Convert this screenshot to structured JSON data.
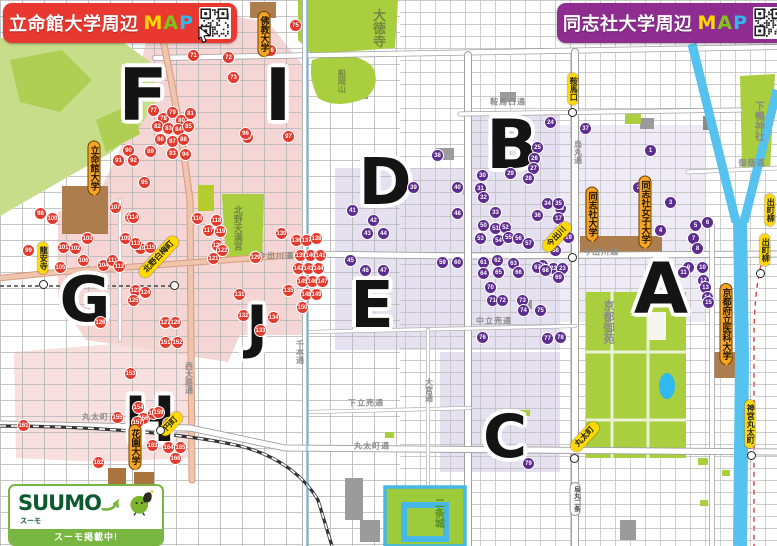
{
  "banners": {
    "left": {
      "title": "立命館大学周辺",
      "map_m": "M",
      "map_a": "A",
      "map_p": "P",
      "bg": "#e8382f"
    },
    "right": {
      "title": "同志社大学周辺",
      "map_m": "M",
      "map_a": "A",
      "map_p": "P",
      "bg": "#8e2d8f"
    }
  },
  "map_colors": {
    "red_marker": "#e33a2e",
    "purple_marker": "#5d2c8f",
    "pink_zone": "#f5cfcc",
    "purple_zone": "#ded9ec",
    "park": "#a9ce3e",
    "river": "#55c2ef",
    "map_m": "#ffd800",
    "map_a": "#7fc31c",
    "map_p": "#2fb9ee"
  },
  "suumo": {
    "brand": "SUUMO",
    "brand_sub": "スーモ",
    "banner": "スーモ掲載中!"
  },
  "zones": [
    {
      "label": "F",
      "x": 143,
      "y": 95,
      "size": 72
    },
    {
      "label": "I",
      "x": 278,
      "y": 95,
      "size": 72
    },
    {
      "label": "G",
      "x": 85,
      "y": 300,
      "size": 62
    },
    {
      "label": "J",
      "x": 257,
      "y": 327,
      "size": 58
    },
    {
      "label": "H",
      "x": 150,
      "y": 420,
      "size": 62
    },
    {
      "label": "D",
      "x": 385,
      "y": 183,
      "size": 64
    },
    {
      "label": "E",
      "x": 372,
      "y": 306,
      "size": 64
    },
    {
      "label": "B",
      "x": 512,
      "y": 146,
      "size": 68
    },
    {
      "label": "C",
      "x": 505,
      "y": 437,
      "size": 60
    },
    {
      "label": "A",
      "x": 661,
      "y": 289,
      "size": 70
    }
  ],
  "universities": [
    {
      "label": "立命館大学",
      "x": 94,
      "y": 168
    },
    {
      "label": "佛教大学",
      "x": 264,
      "y": 34
    },
    {
      "label": "花園大学",
      "x": 135,
      "y": 447
    },
    {
      "label": "同志社大学",
      "x": 592,
      "y": 214
    },
    {
      "label": "同志社女子大学",
      "x": 645,
      "y": 212
    },
    {
      "label": "京都府立医科大学",
      "x": 726,
      "y": 324
    }
  ],
  "stations": [
    {
      "label": "龍安寺",
      "x": 43,
      "y": 258,
      "kind": "v",
      "dot": [
        43,
        284
      ]
    },
    {
      "label": "北野白梅町",
      "x": 159,
      "y": 257,
      "kind": "d",
      "dot": [
        174,
        285
      ]
    },
    {
      "label": "円町",
      "x": 171,
      "y": 424,
      "kind": "d",
      "dot": [
        160,
        430
      ]
    },
    {
      "label": "鞍馬口",
      "x": 573,
      "y": 89,
      "kind": "v",
      "dot": [
        572,
        112
      ]
    },
    {
      "label": "今出川",
      "x": 557,
      "y": 237,
      "kind": "d",
      "dot": [
        572,
        257
      ]
    },
    {
      "label": "丸太町",
      "x": 585,
      "y": 437,
      "kind": "d",
      "dot": [
        574,
        458
      ]
    },
    {
      "label": "烏丸二条",
      "x": 575,
      "y": 499,
      "kind": "w",
      "dot": null
    },
    {
      "label": "神宮丸太町",
      "x": 750,
      "y": 424,
      "kind": "v",
      "dot": [
        751,
        455
      ]
    },
    {
      "label": "出町柳",
      "x": 770,
      "y": 210,
      "kind": "v",
      "dot": null
    },
    {
      "label": "出町柳",
      "x": 765,
      "y": 250,
      "kind": "v",
      "dot": [
        760,
        273
      ]
    }
  ],
  "places": [
    {
      "label": "大徳寺",
      "x": 378,
      "y": 28,
      "color": "#74883e",
      "vertical": true,
      "size": 13
    },
    {
      "label": "船岡山",
      "x": 341,
      "y": 81,
      "color": "#74883e",
      "vertical": true,
      "size": 8
    },
    {
      "label": "北野天満宮",
      "x": 237,
      "y": 228,
      "color": "#74883e",
      "vertical": true,
      "size": 9
    },
    {
      "label": "下鴨神社",
      "x": 757,
      "y": 121,
      "color": "#8a8a8a",
      "vertical": true,
      "size": 10
    },
    {
      "label": "京都御苑",
      "x": 607,
      "y": 322,
      "color": "#8a8a8a",
      "vertical": true,
      "size": 11
    },
    {
      "label": "二条城",
      "x": 437,
      "y": 513,
      "color": "#4f8f22",
      "vertical": true,
      "size": 10
    }
  ],
  "roads": [
    {
      "label": "今出川通",
      "x": 276,
      "y": 256,
      "vertical": false
    },
    {
      "label": "今出川通",
      "x": 601,
      "y": 252,
      "vertical": false
    },
    {
      "label": "鞍馬口通",
      "x": 508,
      "y": 102,
      "vertical": false
    },
    {
      "label": "烏丸通",
      "x": 578,
      "y": 152,
      "vertical": true
    },
    {
      "label": "千本通",
      "x": 300,
      "y": 352,
      "vertical": true
    },
    {
      "label": "大宮通",
      "x": 429,
      "y": 390,
      "vertical": true
    },
    {
      "label": "西大路通",
      "x": 189,
      "y": 378,
      "vertical": true
    },
    {
      "label": "丸太町通",
      "x": 100,
      "y": 417,
      "vertical": false
    },
    {
      "label": "丸太町通",
      "x": 372,
      "y": 446,
      "vertical": false
    },
    {
      "label": "下立売通",
      "x": 366,
      "y": 403,
      "vertical": false
    },
    {
      "label": "中立売通",
      "x": 494,
      "y": 321,
      "vertical": false
    },
    {
      "label": "御蔭通",
      "x": 752,
      "y": 163,
      "vertical": false
    }
  ],
  "red_markers": [
    [
      193,
      55,
      "71"
    ],
    [
      228,
      57,
      "72"
    ],
    [
      233,
      77,
      "73"
    ],
    [
      247,
      137,
      "74"
    ],
    [
      295,
      25,
      "75"
    ],
    [
      270,
      50,
      "76"
    ],
    [
      153,
      110,
      "77"
    ],
    [
      163,
      118,
      "78"
    ],
    [
      172,
      112,
      "79"
    ],
    [
      181,
      120,
      "80"
    ],
    [
      190,
      113,
      "81"
    ],
    [
      157,
      126,
      "82"
    ],
    [
      168,
      128,
      "83"
    ],
    [
      178,
      129,
      "84"
    ],
    [
      188,
      126,
      "85"
    ],
    [
      160,
      139,
      "86"
    ],
    [
      172,
      141,
      "87"
    ],
    [
      183,
      139,
      "88"
    ],
    [
      150,
      151,
      "89"
    ],
    [
      128,
      150,
      "90"
    ],
    [
      118,
      160,
      "91"
    ],
    [
      133,
      160,
      "92"
    ],
    [
      172,
      153,
      "93"
    ],
    [
      185,
      154,
      "94"
    ],
    [
      144,
      182,
      "95"
    ],
    [
      245,
      133,
      "96"
    ],
    [
      288,
      136,
      "97"
    ],
    [
      40,
      213,
      "98"
    ],
    [
      28,
      250,
      "99"
    ],
    [
      52,
      218,
      "100"
    ],
    [
      63,
      247,
      "101"
    ],
    [
      75,
      248,
      "102"
    ],
    [
      87,
      238,
      "103"
    ],
    [
      103,
      265,
      "104"
    ],
    [
      60,
      267,
      "105"
    ],
    [
      83,
      260,
      "106"
    ],
    [
      115,
      207,
      "107"
    ],
    [
      130,
      217,
      "108"
    ],
    [
      125,
      238,
      "109"
    ],
    [
      140,
      248,
      "110"
    ],
    [
      112,
      260,
      "111"
    ],
    [
      119,
      266,
      "112"
    ],
    [
      135,
      243,
      "113"
    ],
    [
      133,
      217,
      "114"
    ],
    [
      150,
      247,
      "115"
    ],
    [
      197,
      218,
      "116"
    ],
    [
      208,
      230,
      "117"
    ],
    [
      216,
      220,
      "118"
    ],
    [
      220,
      231,
      "119"
    ],
    [
      217,
      245,
      "120"
    ],
    [
      213,
      258,
      "121"
    ],
    [
      222,
      250,
      "122"
    ],
    [
      135,
      290,
      "123"
    ],
    [
      145,
      292,
      "124"
    ],
    [
      133,
      300,
      "125"
    ],
    [
      100,
      322,
      "126"
    ],
    [
      165,
      322,
      "127"
    ],
    [
      175,
      322,
      "128"
    ],
    [
      255,
      257,
      "129"
    ],
    [
      281,
      233,
      "130"
    ],
    [
      239,
      294,
      "131"
    ],
    [
      243,
      315,
      "132"
    ],
    [
      260,
      330,
      "133"
    ],
    [
      273,
      317,
      "134"
    ],
    [
      288,
      290,
      "135"
    ],
    [
      296,
      240,
      "136"
    ],
    [
      306,
      240,
      "137"
    ],
    [
      316,
      238,
      "138"
    ],
    [
      300,
      255,
      "139"
    ],
    [
      310,
      255,
      "140"
    ],
    [
      320,
      255,
      "141"
    ],
    [
      298,
      268,
      "142"
    ],
    [
      308,
      268,
      "143"
    ],
    [
      318,
      268,
      "144"
    ],
    [
      302,
      281,
      "145"
    ],
    [
      312,
      281,
      "146"
    ],
    [
      322,
      281,
      "147"
    ],
    [
      306,
      294,
      "148"
    ],
    [
      316,
      294,
      "149"
    ],
    [
      302,
      307,
      "150"
    ],
    [
      165,
      342,
      "151"
    ],
    [
      177,
      342,
      "152"
    ],
    [
      130,
      373,
      "153"
    ],
    [
      138,
      407,
      "154"
    ],
    [
      117,
      417,
      "155"
    ],
    [
      143,
      418,
      "156"
    ],
    [
      137,
      422,
      "157"
    ],
    [
      153,
      413,
      "158"
    ],
    [
      158,
      412,
      "159"
    ],
    [
      168,
      423,
      "160"
    ],
    [
      23,
      425,
      "161"
    ],
    [
      98,
      462,
      "162"
    ],
    [
      152,
      445,
      "163"
    ],
    [
      168,
      447,
      "164"
    ],
    [
      180,
      447,
      "165"
    ],
    [
      175,
      458,
      "166"
    ]
  ],
  "purple_markers": [
    [
      650,
      150,
      "1"
    ],
    [
      638,
      187,
      "2"
    ],
    [
      670,
      202,
      "3"
    ],
    [
      660,
      230,
      "4"
    ],
    [
      695,
      225,
      "5"
    ],
    [
      707,
      222,
      "6"
    ],
    [
      693,
      238,
      "7"
    ],
    [
      697,
      248,
      "8"
    ],
    [
      688,
      267,
      "9"
    ],
    [
      702,
      267,
      "10"
    ],
    [
      683,
      272,
      "11"
    ],
    [
      703,
      280,
      "12"
    ],
    [
      705,
      287,
      "13"
    ],
    [
      707,
      297,
      "14"
    ],
    [
      708,
      302,
      "15"
    ],
    [
      560,
      208,
      "16"
    ],
    [
      558,
      218,
      "17"
    ],
    [
      563,
      228,
      "18"
    ],
    [
      568,
      237,
      "19"
    ],
    [
      553,
      248,
      "20"
    ],
    [
      542,
      265,
      "21"
    ],
    [
      553,
      268,
      "22"
    ],
    [
      562,
      268,
      "23"
    ],
    [
      550,
      122,
      "24"
    ],
    [
      537,
      147,
      "25"
    ],
    [
      534,
      158,
      "26"
    ],
    [
      533,
      168,
      "27"
    ],
    [
      528,
      178,
      "28"
    ],
    [
      510,
      173,
      "29"
    ],
    [
      482,
      175,
      "30"
    ],
    [
      480,
      188,
      "31"
    ],
    [
      483,
      197,
      "32"
    ],
    [
      495,
      212,
      "33"
    ],
    [
      547,
      203,
      "34"
    ],
    [
      558,
      203,
      "35"
    ],
    [
      537,
      215,
      "36"
    ],
    [
      585,
      128,
      "37"
    ],
    [
      437,
      155,
      "38"
    ],
    [
      413,
      187,
      "39"
    ],
    [
      457,
      187,
      "40"
    ],
    [
      352,
      210,
      "41"
    ],
    [
      373,
      220,
      "42"
    ],
    [
      367,
      233,
      "43"
    ],
    [
      383,
      233,
      "44"
    ],
    [
      350,
      260,
      "45"
    ],
    [
      365,
      270,
      "46"
    ],
    [
      383,
      270,
      "47"
    ],
    [
      457,
      213,
      "48"
    ],
    [
      480,
      237,
      "49"
    ],
    [
      483,
      225,
      "50"
    ],
    [
      495,
      228,
      "51"
    ],
    [
      505,
      227,
      "52"
    ],
    [
      480,
      238,
      "53"
    ],
    [
      498,
      240,
      "54"
    ],
    [
      508,
      237,
      "55"
    ],
    [
      518,
      238,
      "56"
    ],
    [
      528,
      243,
      "57"
    ],
    [
      555,
      250,
      "58"
    ],
    [
      442,
      262,
      "59"
    ],
    [
      457,
      262,
      "60"
    ],
    [
      483,
      262,
      "61"
    ],
    [
      497,
      260,
      "62"
    ],
    [
      513,
      263,
      "63"
    ],
    [
      483,
      273,
      "64"
    ],
    [
      498,
      272,
      "65"
    ],
    [
      518,
      272,
      "66"
    ],
    [
      537,
      267,
      "67"
    ],
    [
      545,
      270,
      "68"
    ],
    [
      558,
      277,
      "69"
    ],
    [
      490,
      287,
      "70"
    ],
    [
      492,
      300,
      "71"
    ],
    [
      502,
      300,
      "72"
    ],
    [
      522,
      300,
      "73"
    ],
    [
      523,
      310,
      "74"
    ],
    [
      540,
      310,
      "75"
    ],
    [
      482,
      337,
      "76"
    ],
    [
      547,
      338,
      "77"
    ],
    [
      560,
      337,
      "78"
    ],
    [
      528,
      463,
      "79"
    ]
  ]
}
